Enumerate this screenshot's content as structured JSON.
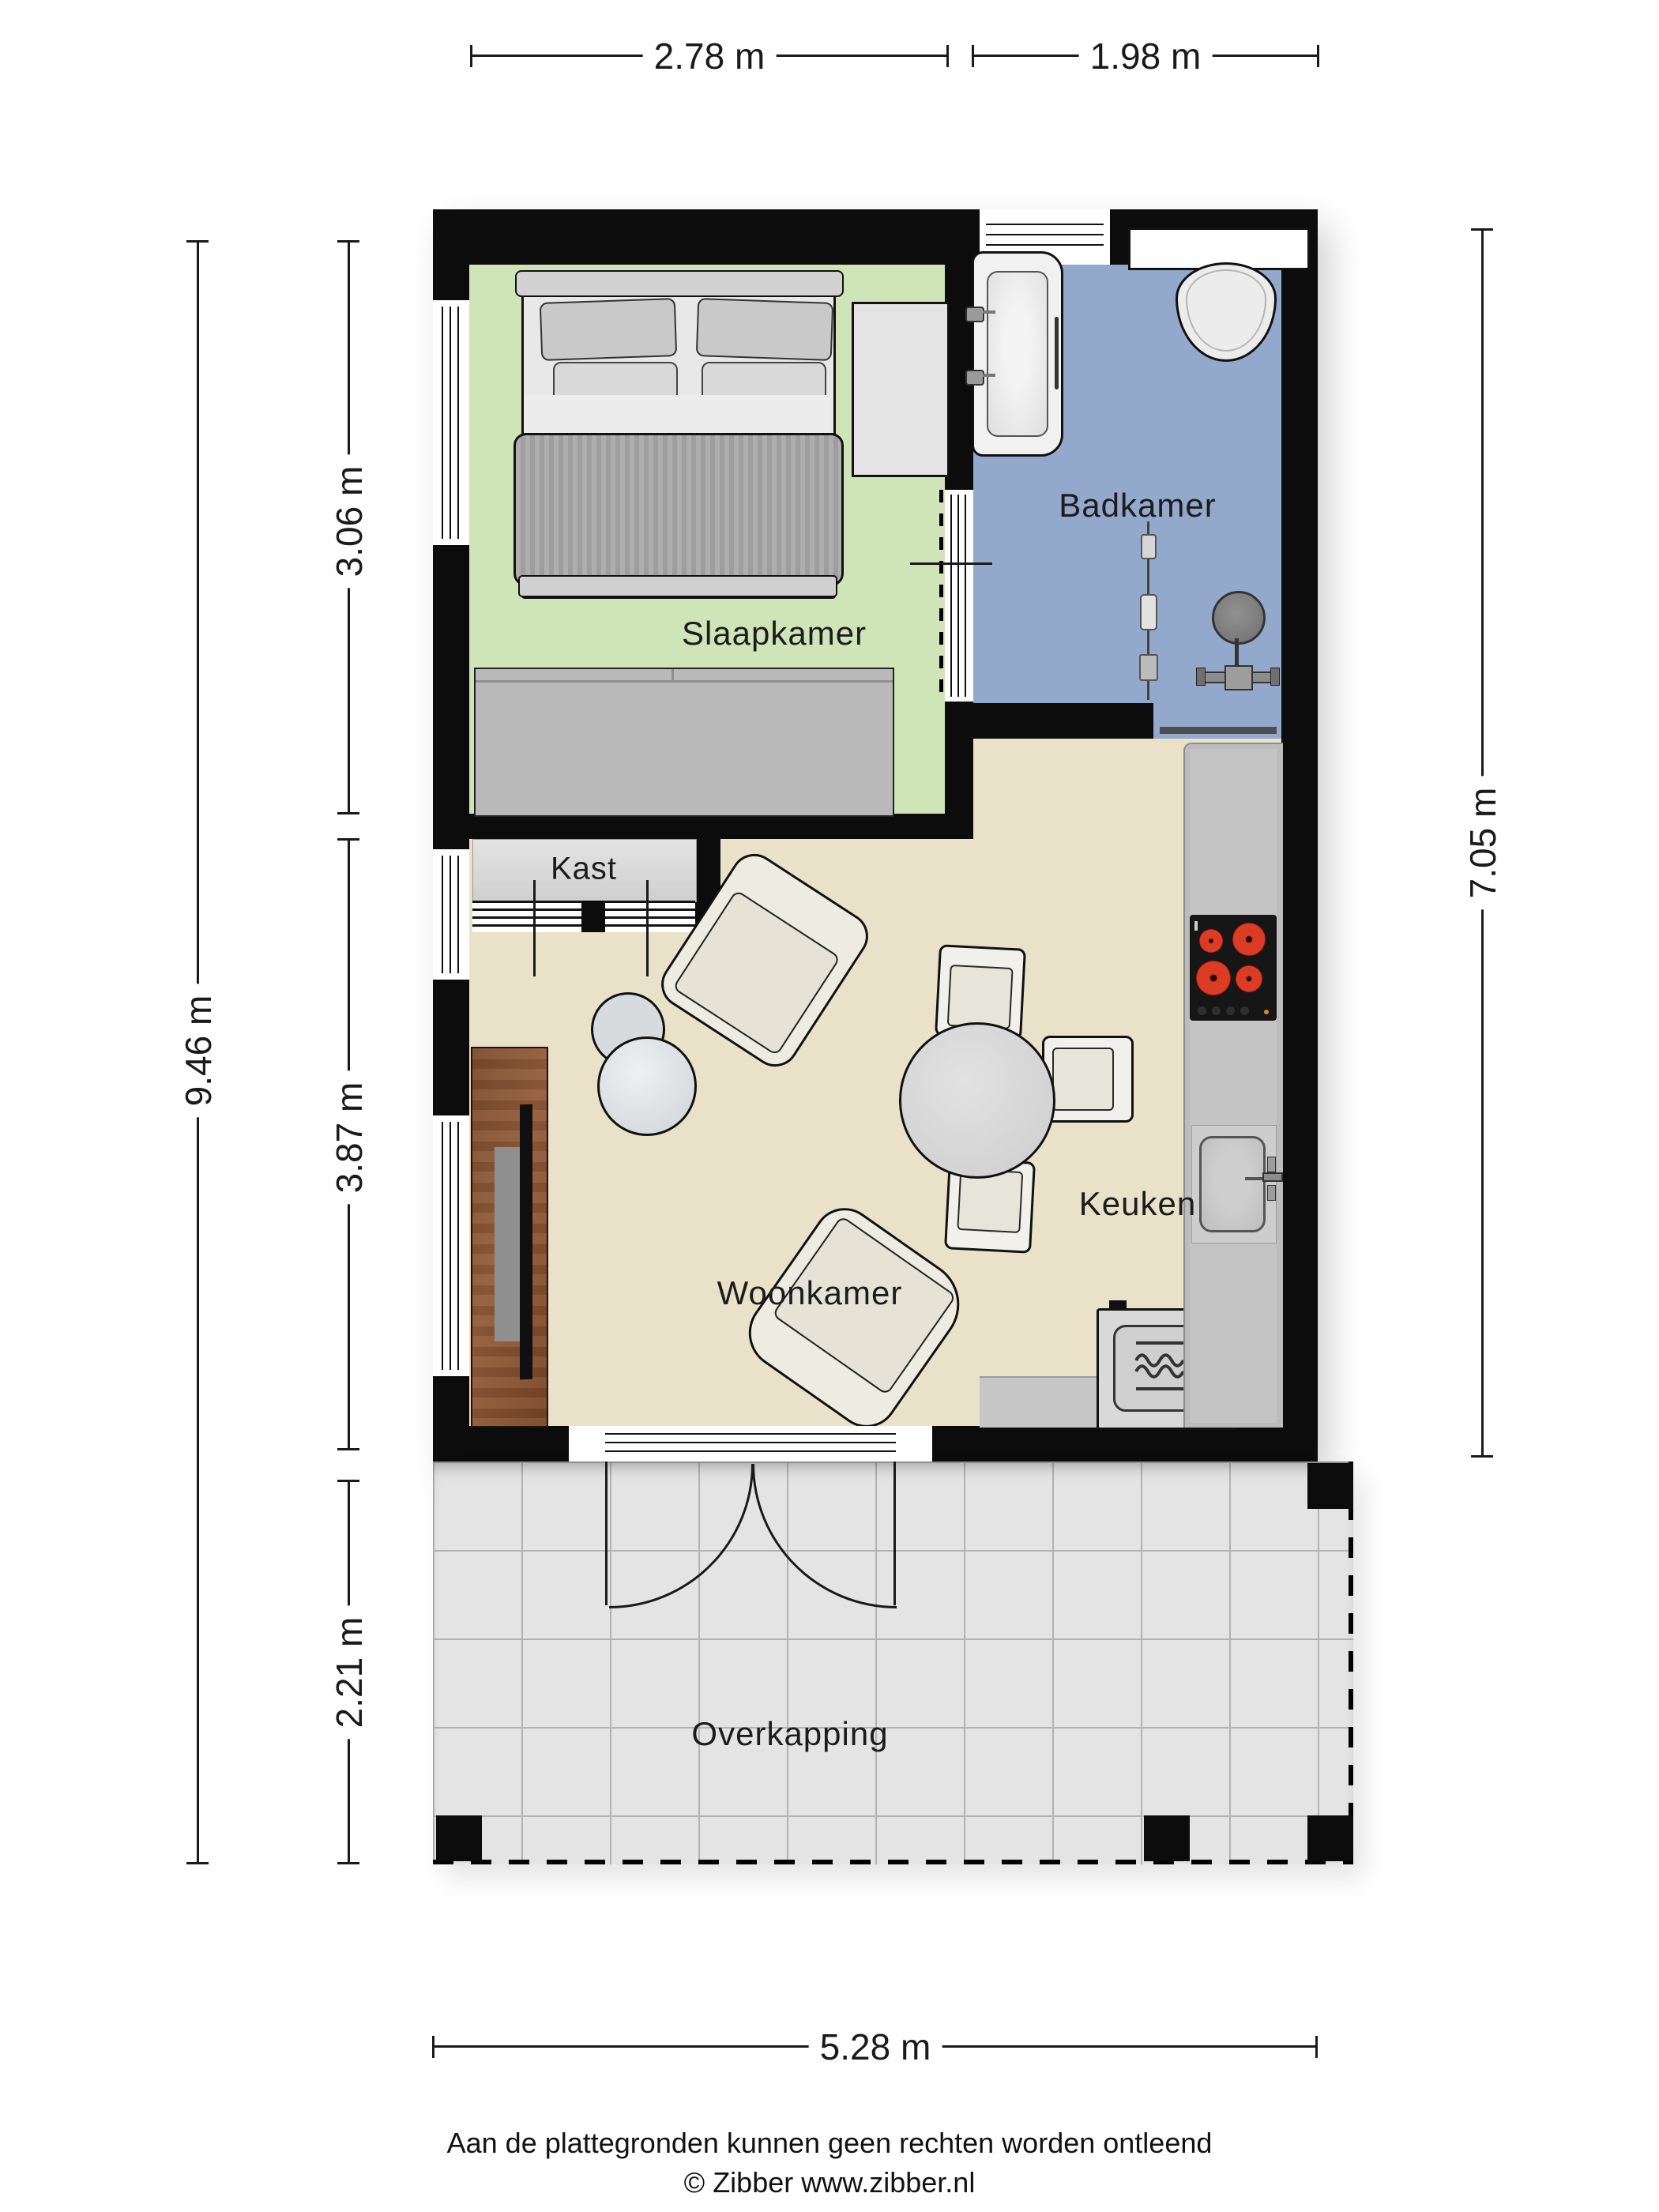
{
  "dimensions": {
    "top": [
      {
        "label": "2.78 m"
      },
      {
        "label": "1.98 m"
      }
    ],
    "left_outer": {
      "label": "9.46 m"
    },
    "left_inner": [
      {
        "label": "3.06 m"
      },
      {
        "label": "3.87 m"
      },
      {
        "label": "2.21 m"
      }
    ],
    "right": {
      "label": "7.05 m"
    },
    "bottom": {
      "label": "5.28 m"
    }
  },
  "rooms": {
    "slaapkamer": {
      "label": "Slaapkamer",
      "floor_color": "#cfe4b7"
    },
    "badkamer": {
      "label": "Badkamer",
      "floor_color": "#93a9cc"
    },
    "woonkamer": {
      "label": "Woonkamer",
      "floor_color": "#e9e1c8"
    },
    "keuken": {
      "label": "Keuken"
    },
    "kast": {
      "label": "Kast"
    },
    "overkapping": {
      "label": "Overkapping",
      "floor_color": "#e4e4e4"
    }
  },
  "icons": [
    "double-bed",
    "pillow",
    "dresser",
    "desk",
    "bathtub",
    "toilet",
    "shower-head",
    "shower-rail",
    "closet-sliding-door",
    "armchair",
    "coffee-table",
    "dining-table",
    "dining-chair",
    "tv-cabinet",
    "television",
    "microwave",
    "cooktop",
    "kitchen-sink",
    "door-swing",
    "window",
    "wall-post"
  ],
  "palette": {
    "wall": "#0c0c0c",
    "dimension_line": "#1a1a1a",
    "counter": "#bcbcbc",
    "cooktop": "#161616",
    "burner_red": "#d83a22",
    "tv_cabinet_wood": "#7c4c2e",
    "threshold_gray": "#4f4f4f",
    "tile_grid": "#b3b3b3"
  },
  "footer": {
    "line1": "Aan de plattegronden kunnen geen rechten worden ontleend",
    "line2": "© Zibber www.zibber.nl"
  }
}
